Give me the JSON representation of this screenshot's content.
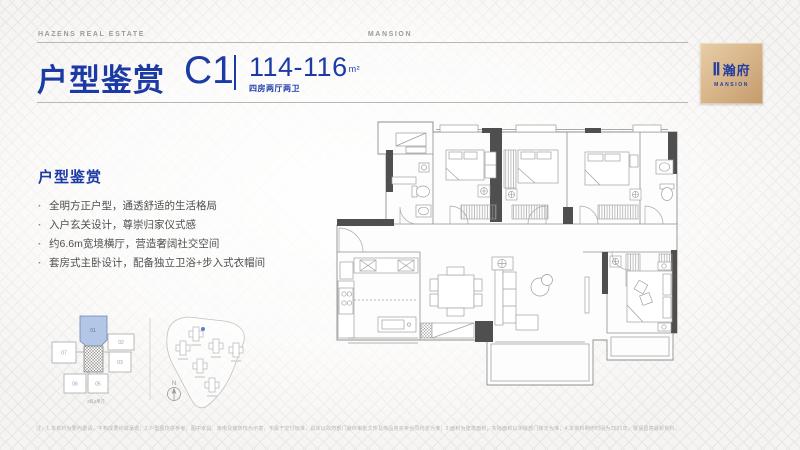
{
  "header": {
    "left_brand": "HAZENS REAL ESTATE",
    "center_brand": "MANSION"
  },
  "title": {
    "main": "户型鉴赏",
    "unit_code": "C1",
    "area_range": "114-116",
    "area_unit": "m²",
    "subtitle": "四房两厅两卫"
  },
  "logo": {
    "roman": "Ⅱ",
    "cn": "瀚府",
    "en": "MANSION"
  },
  "features": {
    "heading": "户型鉴赏",
    "bullets": [
      "全明方正户型，通透舒适的生活格局",
      "入户玄关设计，尊崇归家仪式感",
      "约6.6m宽境横厅，营造奢阔社交空间",
      "套房式主卧设计，配备独立卫浴+步入式衣帽间"
    ]
  },
  "keyplan": {
    "units": [
      "01",
      "02",
      "03",
      "05",
      "06",
      "07"
    ],
    "highlighted_unit": "01",
    "caption": "2栋2单元"
  },
  "siteplan": {
    "compass_label": "N"
  },
  "footer": {
    "disclaimer": "注：1.本资料为要约邀请，不构成要约或承诺；2.户型图仅供参考，图中家具、家电及装饰仅为示意，不属于交付标准，具体以政府部门最终审批文件及商品房买卖合同约定为准；3.面积为建筑面积，实际面积以测绘部门核定为准；4.本资料制作时间为2021年，敬请留意最新资料。"
  },
  "colors": {
    "accent_blue": "#1c3aa5",
    "logo_gold": "#d3ab7f",
    "highlight_unit": "#b3c6e6"
  }
}
